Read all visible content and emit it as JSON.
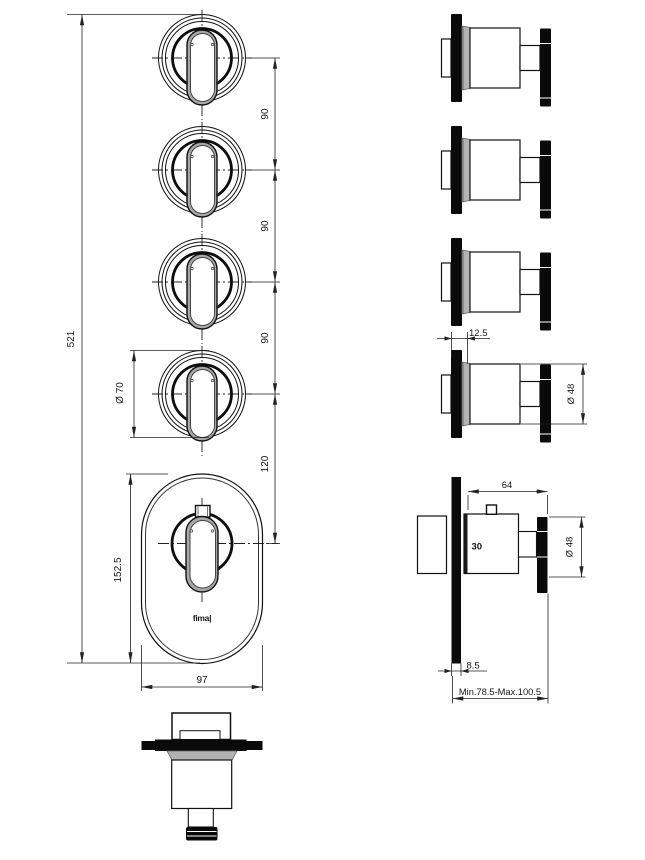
{
  "labels": {
    "brand": "fima|",
    "front": {
      "total_height": "521",
      "spacing_1": "90",
      "spacing_2": "90",
      "spacing_3": "90",
      "valve_offset": "120",
      "knob_diameter": "Ø 70",
      "plate_height": "152.5",
      "plate_width": "97"
    },
    "side": {
      "plate_offset": "12.5",
      "knob_diameter": "Ø 48",
      "valve_depth": "64",
      "temperature_mark": "30",
      "valve_knob_diameter": "Ø 48",
      "plate_thickness": "8.5",
      "install_depth_range": "Min.78.5-Max.100.5"
    }
  }
}
